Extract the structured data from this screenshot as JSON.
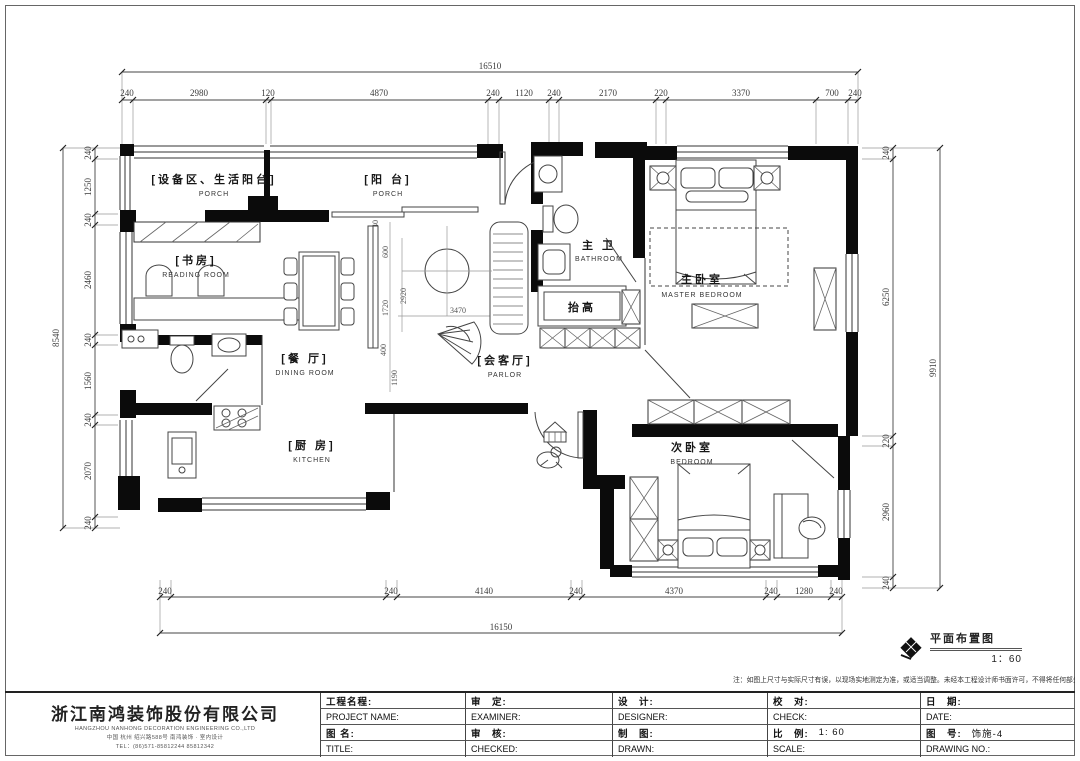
{
  "plan": {
    "stamp": {
      "title": "平面布置图",
      "scale": "1：60"
    },
    "note": "注：如图上尺寸与实际尺寸有误，以现场实地测定为准，或适当调整。未经本工程设计师书面许可，不得将任何部分翻印。",
    "rooms": {
      "utility_balcony": {
        "cn": "[设备区、生活阳台]",
        "en": "PORCH"
      },
      "balcony": {
        "cn": "[阳 台]",
        "en": "PORCH"
      },
      "study": {
        "cn": "[书房]",
        "en": "READING ROOM"
      },
      "dining": {
        "cn": "[餐 厅]",
        "en": "DINING ROOM"
      },
      "kitchen": {
        "cn": "[厨 房]",
        "en": "KITCHEN"
      },
      "parlor": {
        "cn": "[会客厅]",
        "en": "PARLOR"
      },
      "master_bath": {
        "cn": "主 卫",
        "en": "BATHROOM"
      },
      "master_bedroom": {
        "cn": "主卧室",
        "en": "MASTER BEDROOM"
      },
      "second_bedroom": {
        "cn": "次卧室",
        "en": "BEDROOM"
      },
      "raised": {
        "cn": "抬高"
      }
    },
    "dims": {
      "top": {
        "total": "16510",
        "seg": [
          "240",
          "2980",
          "120",
          "4870",
          "240",
          "1120",
          "240",
          "2170",
          "220",
          "3370",
          "700",
          "240"
        ]
      },
      "bottom": {
        "total": "16150",
        "seg": [
          "240",
          "240",
          "4140",
          "240",
          "4370",
          "240",
          "1280",
          "240"
        ]
      },
      "left": {
        "total": "8540",
        "seg": [
          "240",
          "1250",
          "240",
          "2460",
          "240",
          "1560",
          "240",
          "2070",
          "240"
        ]
      },
      "right": {
        "total": "9910",
        "seg": [
          "240",
          "6250",
          "220",
          "2960",
          "240"
        ]
      },
      "interior": {
        "i0": "240",
        "i1": "600",
        "i2": "2920",
        "i3": "1720",
        "i4": "400",
        "i5": "1190",
        "i6": "3470"
      }
    }
  },
  "titleblock": {
    "company": {
      "name": "浙江南鸿装饰股份有限公司",
      "en": "HANGZHOU NANHONG DECORATION ENGINEERING CO.,LTD",
      "address": "中国 杭州 绍兴路588号 南鸿装饰 · 室内设计",
      "tel": "TEL：(86)571-85812244  85812342"
    },
    "fields": {
      "project_cn": "工程名程:",
      "project_en": "PROJECT NAME:",
      "title_cn": "图 名:",
      "title_en": "TITLE:",
      "examine_cn": "审　定:",
      "examine_en": "EXAMINER:",
      "check2_cn": "审　核:",
      "check2_en": "CHECKED:",
      "design_cn": "设　计:",
      "design_en": "DESIGNER:",
      "draw_cn": "制　图:",
      "draw_en": "DRAWN:",
      "proof_cn": "校　对:",
      "proof_en": "CHECK:",
      "date_cn": "日　期:",
      "date_en": "DATE:",
      "scale_cn": "比　例:",
      "scale_value": "1: 60",
      "scale_en": "SCALE:",
      "no_cn": "图　号:",
      "no_value": "饰施-4",
      "no_en": "DRAWING NO.:"
    }
  }
}
